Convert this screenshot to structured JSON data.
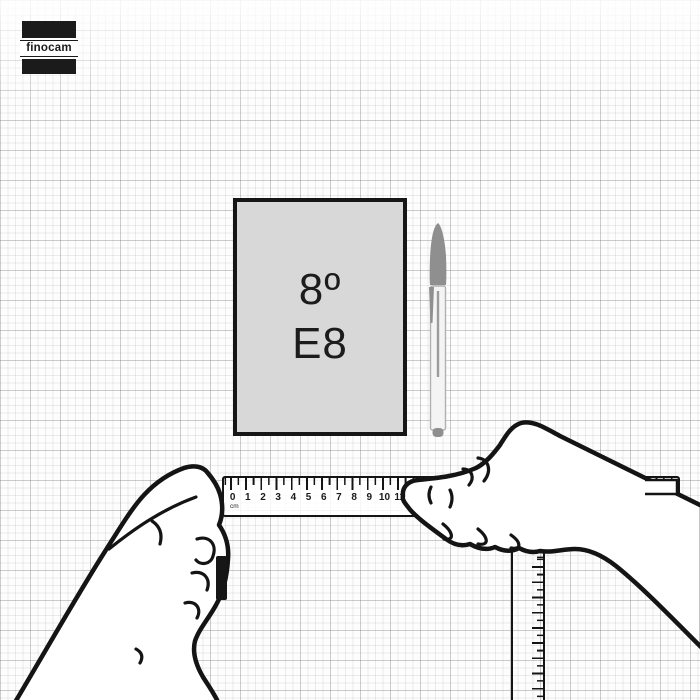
{
  "logo": {
    "text": "finocam"
  },
  "notebook": {
    "size_label": "8º",
    "model_label": "E8"
  },
  "ruler": {
    "unit_label": "cm",
    "numbers": [
      "0",
      "1",
      "2",
      "3",
      "4",
      "5",
      "6",
      "7",
      "8",
      "9",
      "10",
      "11",
      "12"
    ]
  },
  "illustrations": {
    "pen": "ballpoint-pen",
    "left_hand": "left-hand-holding-ruler",
    "right_hand": "right-hand-holding-ruler",
    "vertical_ruler": "transparent-ruler"
  },
  "colors": {
    "outline": "#141414",
    "notebook_fill": "#d8d8d8",
    "notebook_border": "#161616",
    "pen_gray": "#8f8f8f",
    "logo_bg": "#1b1b1b",
    "grid_minor": "#e4e4e4",
    "grid_major": "#cfcfcf"
  }
}
